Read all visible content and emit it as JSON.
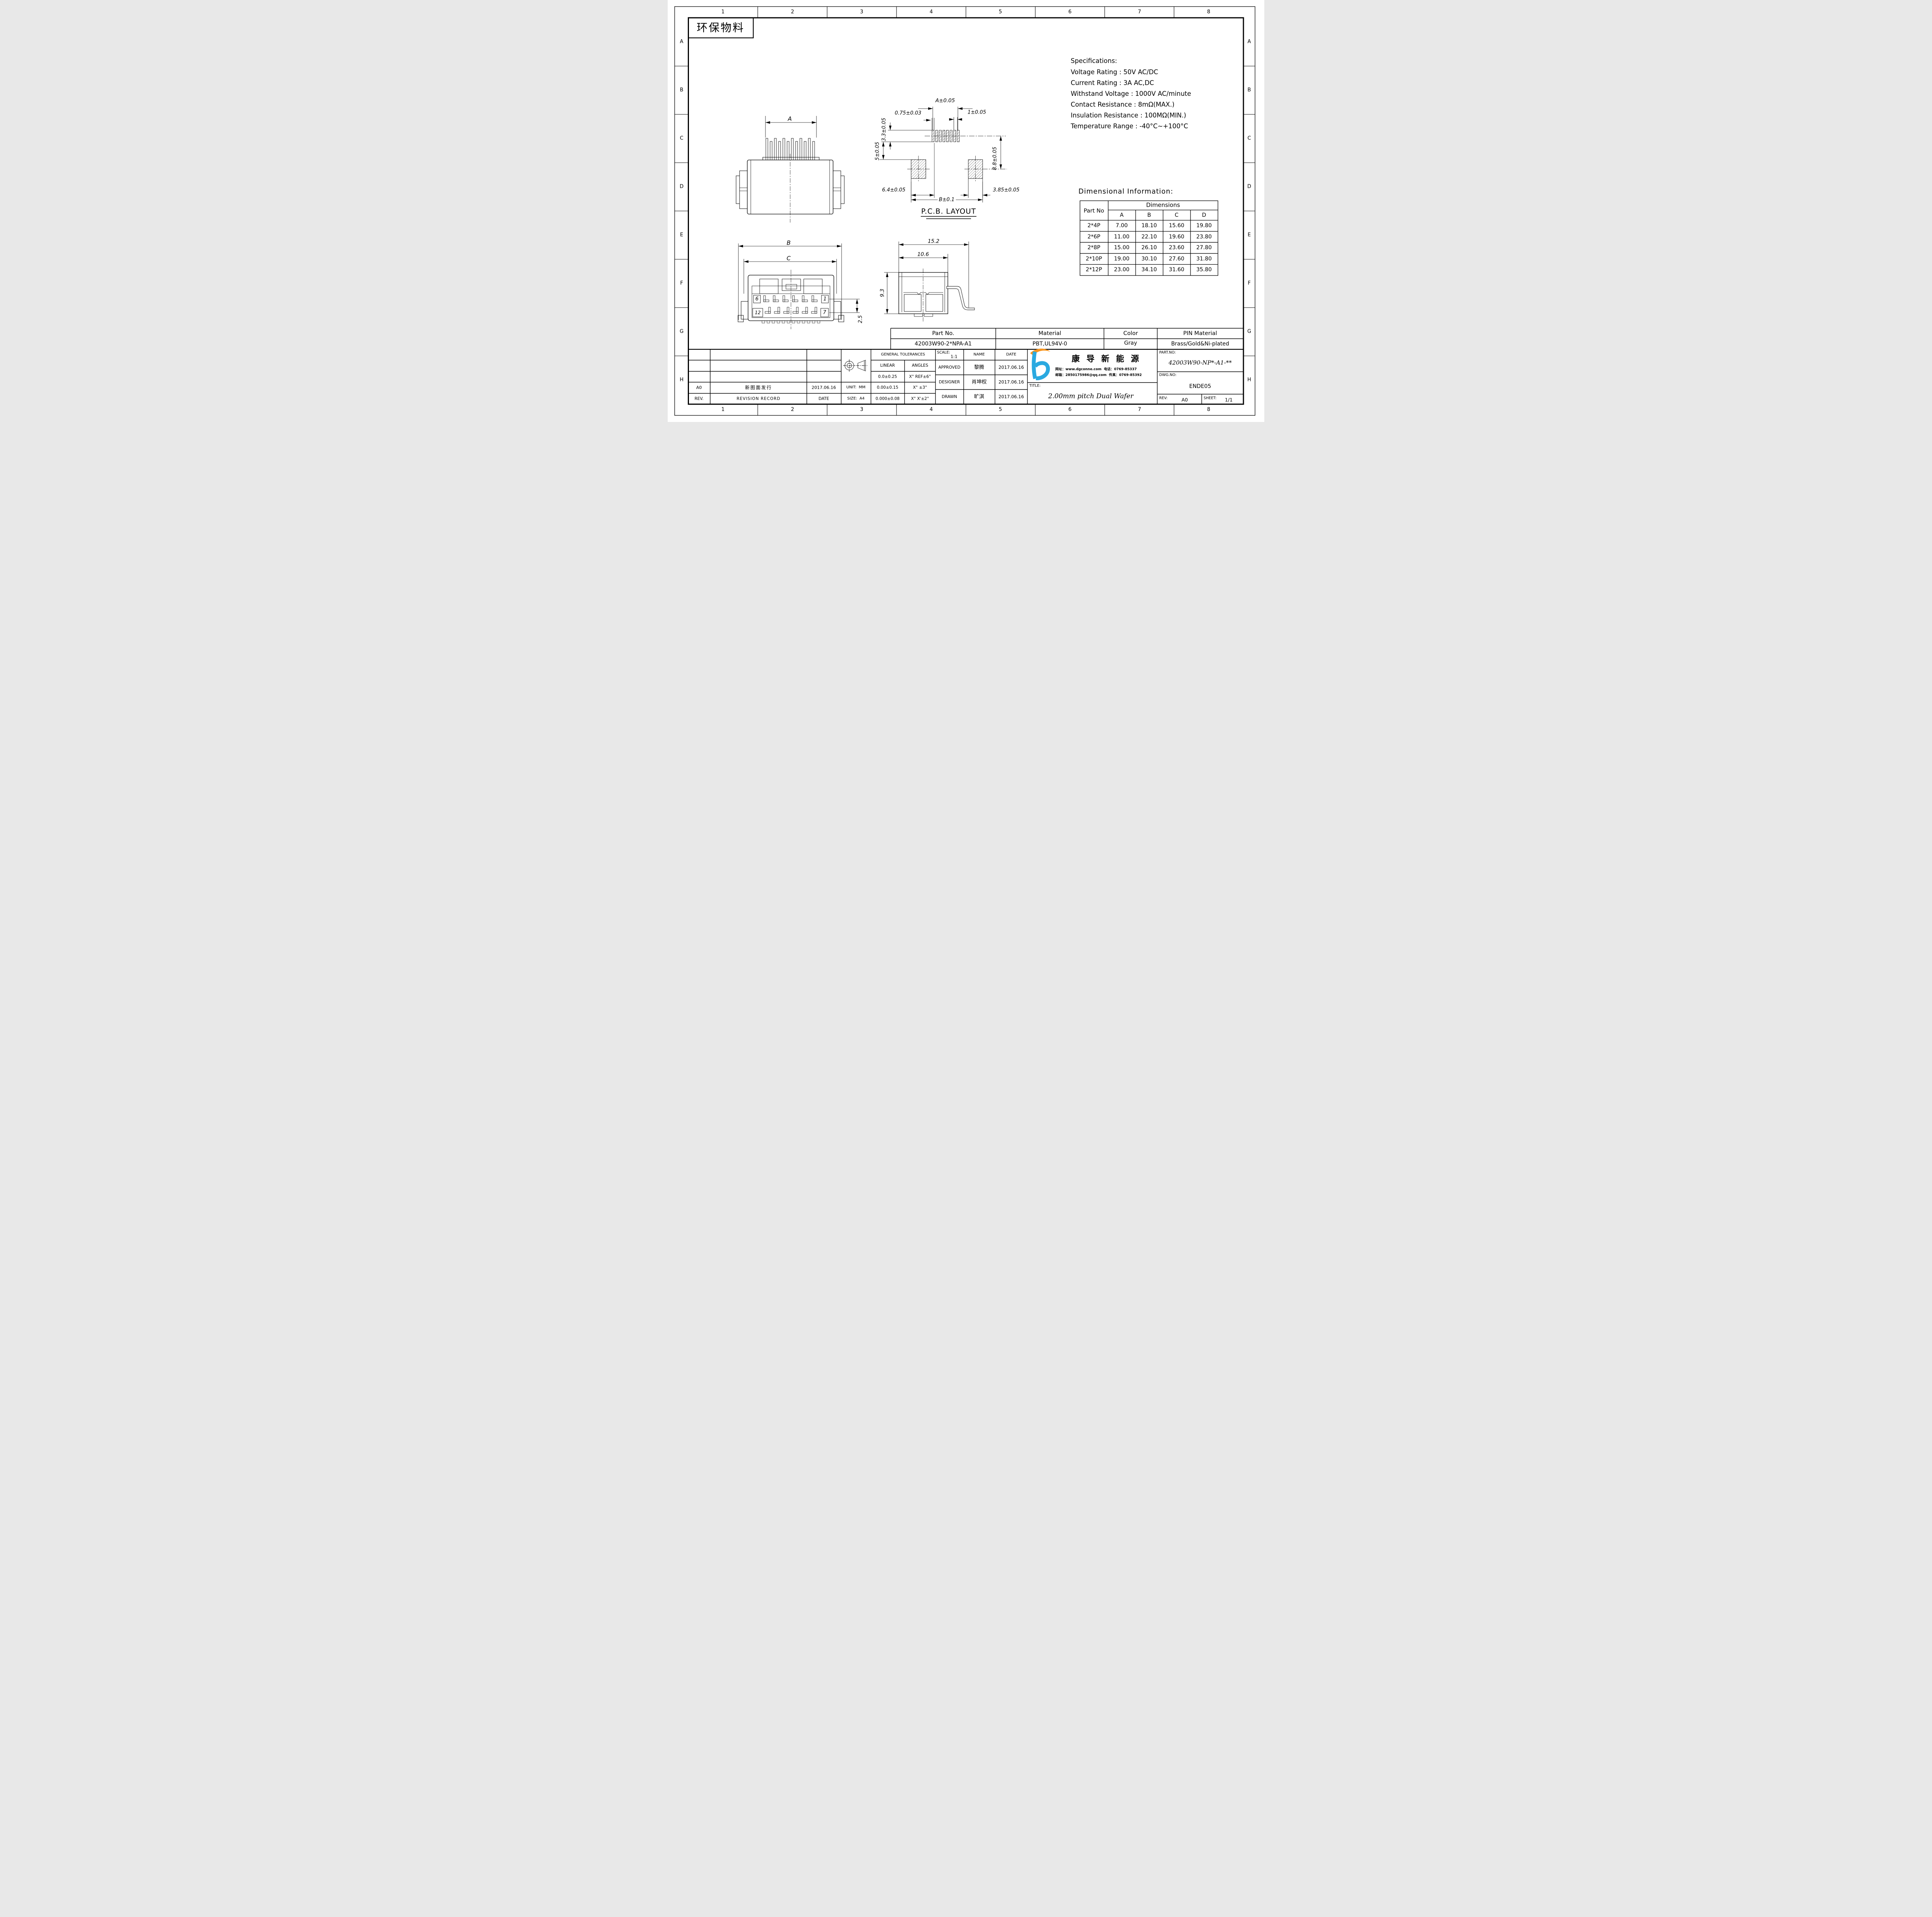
{
  "zones": {
    "cols": [
      "1",
      "2",
      "3",
      "4",
      "5",
      "6",
      "7",
      "8"
    ],
    "rows": [
      "A",
      "B",
      "C",
      "D",
      "E",
      "F",
      "G",
      "H"
    ]
  },
  "eco_label": "环保物料",
  "specs": {
    "title": "Specifications:",
    "lines": [
      "Voltage Rating : 50V AC/DC",
      "Current Rating : 3A AC,DC",
      "Withstand Voltage : 1000V AC/minute",
      "Contact Resistance : 8mΩ(MAX.)",
      "Insulation Resistance : 100MΩ(MIN.)",
      "Temperature Range : -40°C~+100°C"
    ]
  },
  "views": {
    "top": {
      "dim_a": "A"
    },
    "front": {
      "dim_b": "B",
      "dim_c": "C",
      "row_pitch": "2.5",
      "pin_top_left": "6",
      "pin_top_right": "1",
      "pin_bottom_left": "12",
      "pin_bottom_right": "7"
    },
    "side": {
      "dim_width": "15.2",
      "dim_inner": "10.6",
      "dim_height": "9.3"
    },
    "pcb": {
      "title": "P.C.B. LAYOUT",
      "dim_a": "A±0.05",
      "dim_pad": "0.75±0.03",
      "dim_pitch": "1±0.05",
      "dim_33": "3.3±0.05",
      "dim_5": "5±0.05",
      "dim_88": "8.8±0.05",
      "dim_64": "6.4±0.05",
      "dim_385": "3.85±0.05",
      "dim_b": "B±0.1"
    }
  },
  "dim_info": {
    "title": "Dimensional Information:",
    "part_header": "Part No",
    "group_header": "Dimensions",
    "columns": [
      "A",
      "B",
      "C",
      "D"
    ],
    "rows": [
      {
        "part": "2*4P",
        "a": "7.00",
        "b": "18.10",
        "c": "15.60",
        "d": "19.80"
      },
      {
        "part": "2*6P",
        "a": "11.00",
        "b": "22.10",
        "c": "19.60",
        "d": "23.80"
      },
      {
        "part": "2*8P",
        "a": "15.00",
        "b": "26.10",
        "c": "23.60",
        "d": "27.80"
      },
      {
        "part": "2*10P",
        "a": "19.00",
        "b": "30.10",
        "c": "27.60",
        "d": "31.80"
      },
      {
        "part": "2*12P",
        "a": "23.00",
        "b": "34.10",
        "c": "31.60",
        "d": "35.80"
      }
    ]
  },
  "part_table": {
    "part_header": "Part No.",
    "material_header": "Material",
    "color_header": "Color",
    "pin_header": "PIN Material",
    "part": "42003W90-2*NPA-A1",
    "material": "PBT,UL94V-0",
    "color": "Gray",
    "pin": "Brass/Gold&Ni-plated"
  },
  "revision": {
    "rev_header": "REV.",
    "record_header": "REVISION RECORD",
    "date_header": "DATE",
    "rev": "A0",
    "record": "新图面发行",
    "date": "2017.06.16"
  },
  "format": {
    "unit_label": "UNIT:",
    "unit": "MM",
    "size_label": "SIZE:",
    "size": "A4"
  },
  "tolerances": {
    "title": "GENERAL TOLERANCES",
    "linear_header": "LINEAR",
    "angles_header": "ANGLES",
    "rows": [
      {
        "linear": "0.0±0.25",
        "angles": "X° REF±6°"
      },
      {
        "linear": "0.00±0.15",
        "angles": "X° ±3°"
      },
      {
        "linear": "0.000±0.08",
        "angles": "X° X'±2°"
      }
    ]
  },
  "approvals": {
    "scale_label": "SCALE:",
    "scale": "1:1",
    "name_header": "NAME",
    "date_header": "DATE",
    "rows": [
      {
        "role": "APPROVED",
        "name": "黎腾",
        "date": "2017.06.16"
      },
      {
        "role": "DESIGNER",
        "name": "肖坤权",
        "date": "2017.06.16"
      },
      {
        "role": "DRAWN",
        "name": "旷淇",
        "date": "2017.06.16"
      }
    ]
  },
  "company": {
    "name": "康 导 新 能 源",
    "website_label": "网址：",
    "website": "www.dgconne.com",
    "phone_label": "电话：",
    "phone": "0769-85337",
    "email_label": "邮箱：",
    "email": "2850175986@qq.com",
    "fax_label": "传真：",
    "fax": "0769-85392"
  },
  "title_block": {
    "title_label": "TITLE:",
    "title": "2.00mm pitch Dual Wafer",
    "part_no_label": "PART.NO:",
    "part_no": "42003W90-NP*-A1-**",
    "dwg_no_label": "DWG.NO:",
    "dwg_no": "ENDE05",
    "rev_label": "REV:",
    "rev": "A0",
    "sheet_label": "SHEET:",
    "sheet": "1/1"
  },
  "colors": {
    "logo_blue": "#2aa9e0",
    "logo_orange": "#f7941d",
    "line": "#000000"
  }
}
